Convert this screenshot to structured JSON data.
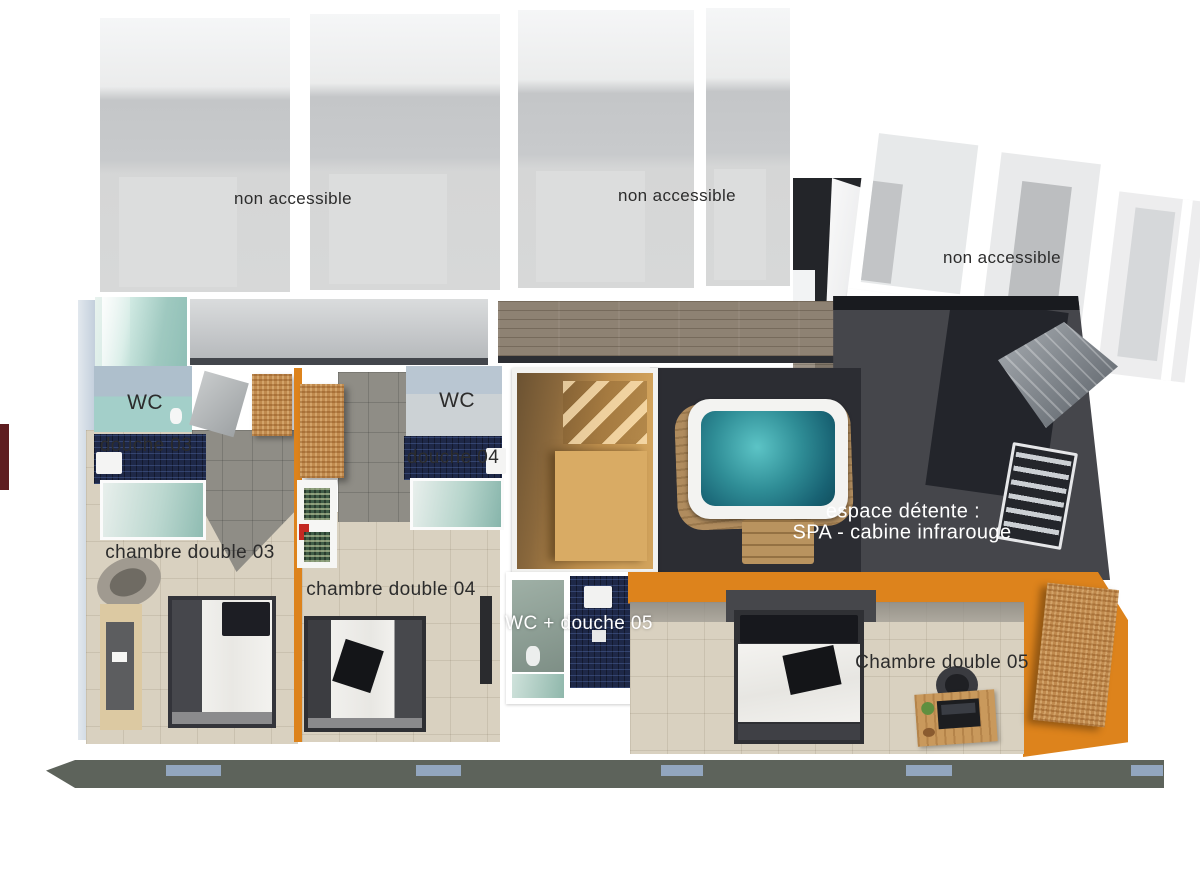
{
  "labels": {
    "non_accessible": "non accessible",
    "wc": "WC",
    "douche_03": "douche 03",
    "chambre_double_03": "chambre double 03",
    "douche_04": "douche 04",
    "chambre_double_04": "chambre double 04",
    "wc_douche_05": "WC + douche 05",
    "chambre_double_05": "Chambre double 05",
    "espace_detente_line1": "espace détente :",
    "espace_detente_line2": "SPA - cabine infrarouge"
  },
  "palette": {
    "accent_orange": "#dd831c",
    "spa_floor_dark": "#45464b",
    "spa_floor_darker": "#26282e",
    "jacuzzi_water": "#2f8d96",
    "sauna_wood": "#c0914f",
    "mosaic_navy": "#1e2848",
    "tile_beige": "#d9d1c0",
    "tile_gray": "#8f8d86",
    "non_accessible_floor": "#c8cacc",
    "window_wall": "#5d635b",
    "window_glass": "#92a6bf",
    "label_dark": "#2c2c2c",
    "label_light": "#ffffff"
  }
}
